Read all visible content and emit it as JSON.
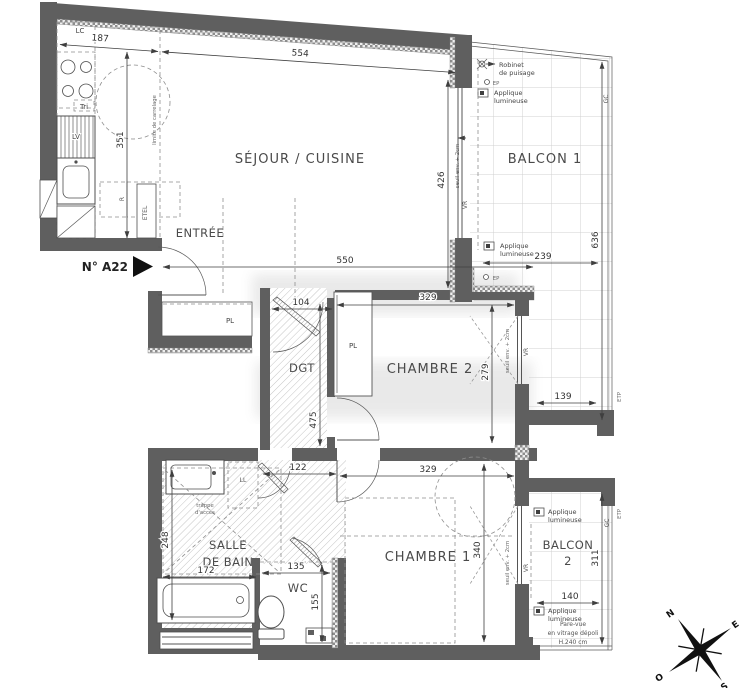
{
  "unit": {
    "number": "N° A22"
  },
  "rooms": {
    "sejour": "SÉJOUR / CUISINE",
    "balcon1": "BALCON 1",
    "entree": "ENTRÉE",
    "dgt": "DGT",
    "chambre2": "CHAMBRE 2",
    "chambre1": "CHAMBRE 1",
    "sdb1": "SALLE",
    "sdb2": "DE BAIN",
    "wc": "WC",
    "balcon2a": "BALCON",
    "balcon2b": "2"
  },
  "dims": {
    "d187": "187",
    "d554": "554",
    "d351": "351",
    "d426": "426",
    "d636": "636",
    "d239": "239",
    "d550": "550",
    "d104": "104",
    "d329t": "329",
    "d279": "279",
    "d475": "475",
    "d122": "122",
    "d329b": "329",
    "d139": "139",
    "d172": "172",
    "d248": "248",
    "d135": "135",
    "d155": "155",
    "d340": "340",
    "d311": "311",
    "d140": "140"
  },
  "labels": {
    "lc": "LC",
    "tri": "Tri",
    "lv": "LV",
    "r": "R",
    "etel": "ETEL",
    "limite": "limite de carrelage",
    "pl": "PL",
    "ll": "LL",
    "vr": "VR",
    "gc": "GC",
    "ep": "EP",
    "etp": "ETP",
    "seuil": "seuil env. + 2cm",
    "robinet1": "Robinet",
    "robinet2": "de puisage",
    "applique1": "Applique",
    "applique2": "lumineuse",
    "trappe1": "trappe",
    "trappe2": "d'accès",
    "parevue1": "Pare-vue",
    "parevue2": "en vitrage dépoli",
    "parevue3": "H.240 cm"
  },
  "compass": {
    "n": "N",
    "e": "E",
    "s": "S",
    "o": "O"
  }
}
